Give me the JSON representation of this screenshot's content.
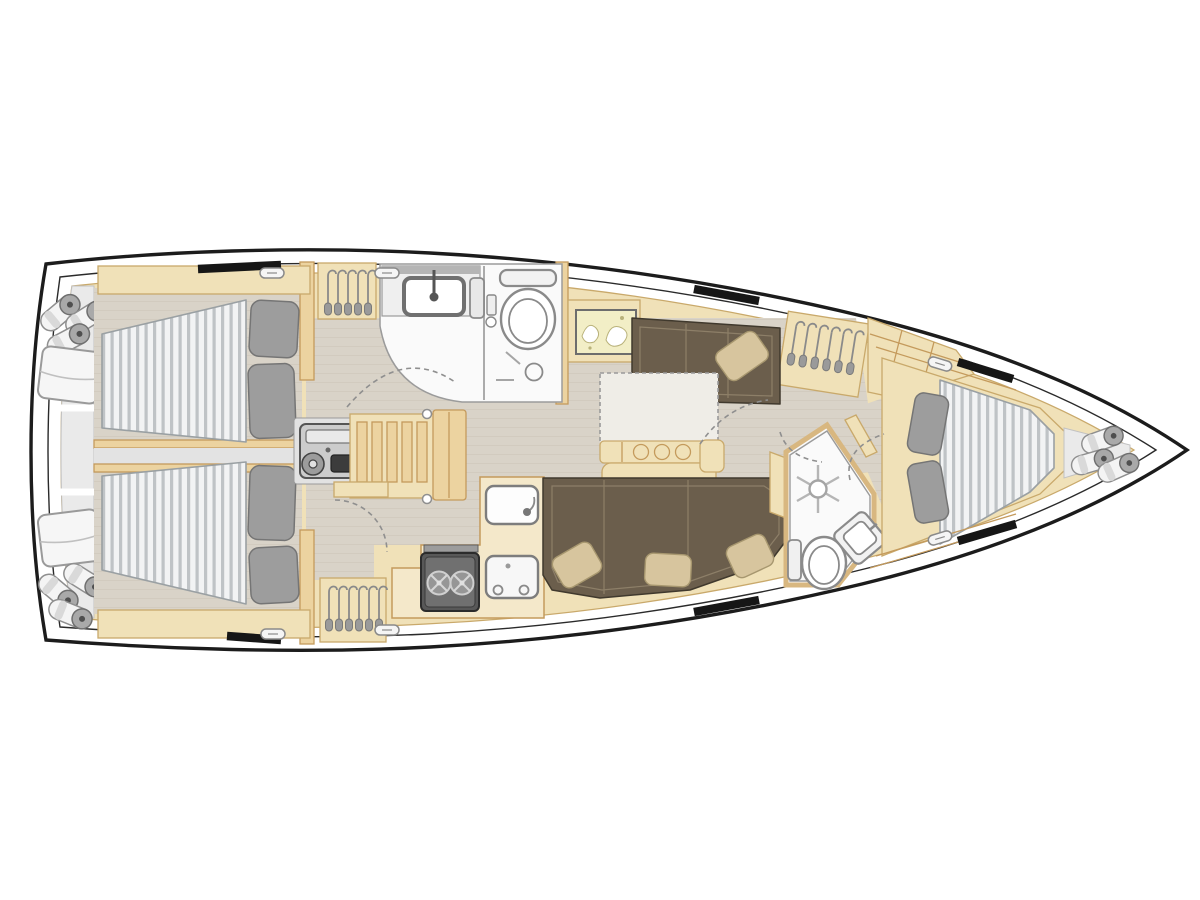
{
  "page": {
    "title": "Sailing yacht interior layout plan (top view, bow to the right)"
  },
  "colors": {
    "hull": "#1c1c1c",
    "deck": "#ffffff",
    "wood": "#f0e1b8",
    "woodLine": "#c9a96b",
    "wall": "#ecd3a0",
    "wallLine": "#c49a5c",
    "floor": "#d9d3c8",
    "floorLine": "#cbc4b7",
    "headFloor": "#fafafa",
    "fixture": "#8a8a8a",
    "transom": "#eaeaea",
    "mattress": "#f2f3f4",
    "mattressStripe": "#bfc3c6",
    "mattressLine": "#9aa0a3",
    "pillow": "#9d9d9d",
    "pillowLine": "#757575",
    "sofa": "#6b5e4c",
    "sofaLine": "#40392d",
    "sofaSeam": "#8d7f68",
    "cushion": "#d7c59e",
    "cushionLine": "#a7976f",
    "window": "#161616",
    "galley": "#f4e8ca",
    "stoveBody": "#585858",
    "map": "#f2eec6"
  },
  "legend": {
    "rooms": [
      "stern-storage-with-fenders",
      "aft-cabin-port-double-bed",
      "aft-cabin-starboard-double-bed",
      "engine-compartment",
      "companionway-stairs",
      "aft-head-with-sink-and-toilet",
      "galley-with-stove-and-sinks",
      "saloon-with-folding-table-and-sofas",
      "forward-head-with-shower-toilet-sink",
      "forward-cabin-v-berth",
      "bow-storage-with-fenders"
    ],
    "icons": [
      "hanger-icon",
      "fender-roll-icon",
      "cushion-pad-icon",
      "latch-icon",
      "sink-icon",
      "faucet-icon",
      "toilet-icon",
      "shower-icon",
      "drain-icon",
      "stove-burner-icon",
      "engine-icon",
      "nautical-chart-icon",
      "door-swing-arc",
      "hull-window",
      "cup-holder-icon",
      "grab-post-icon"
    ]
  }
}
